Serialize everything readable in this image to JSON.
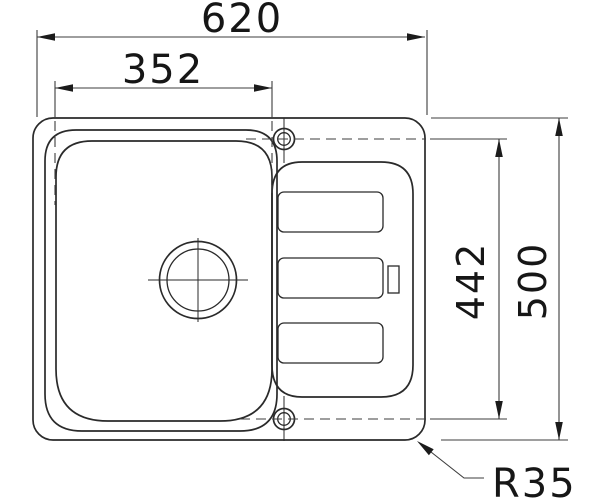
{
  "diagram": {
    "dimensions": {
      "overall_width": "620",
      "bowl_width": "352",
      "hole_span_depth": "442",
      "overall_depth": "500",
      "corner_radius": "R35"
    },
    "colors": {
      "background": "#ffffff",
      "drawing_line": "#2a2a2a",
      "dimension_line": "#3d3d3d",
      "text": "#161616"
    }
  }
}
